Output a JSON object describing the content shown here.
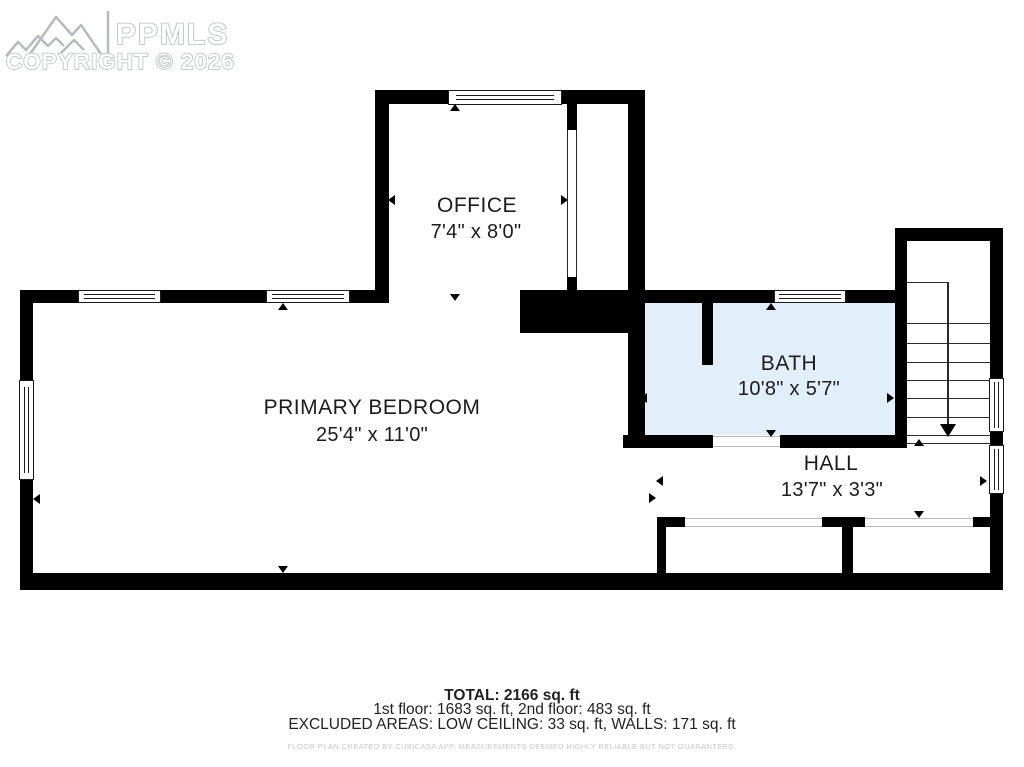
{
  "watermark": {
    "logo_icon": "mountain-logo",
    "brand": "PPMLS",
    "copyright": "COPYRIGHT © 2026"
  },
  "rooms": [
    {
      "name": "OFFICE",
      "dimensions": "7'4\" x 8'0\""
    },
    {
      "name": "PRIMARY BEDROOM",
      "dimensions": "25'4\" x 11'0\""
    },
    {
      "name": "BATH",
      "dimensions": "10'8\" x 5'7\""
    },
    {
      "name": "HALL",
      "dimensions": "13'7\" x 3'3\""
    }
  ],
  "footer": {
    "total": "TOTAL: 2166 sq. ft",
    "floors": "1st floor: 1683 sq. ft, 2nd floor: 483 sq. ft",
    "excluded": "EXCLUDED AREAS: LOW CEILING: 33 sq. ft, WALLS: 171 sq. ft",
    "disclaimer": "FLOOR PLAN CREATED BY CUBICASA APP. MEASUREMENTS DEEMED HIGHLY RELIABLE BUT NOT GUARANTEED."
  },
  "icons": {
    "mountain-logo": "line-art mountain range",
    "dimension-arrow": "small filled triangle",
    "stair-direction-arrow": "filled down triangle with run line"
  },
  "colors": {
    "wall": "#000000",
    "bath_fill": "#e2eefa",
    "text": "#1c1c1c",
    "watermark_stroke": "#b7bbc1",
    "disclaimer_text": "#c9c9c9"
  }
}
